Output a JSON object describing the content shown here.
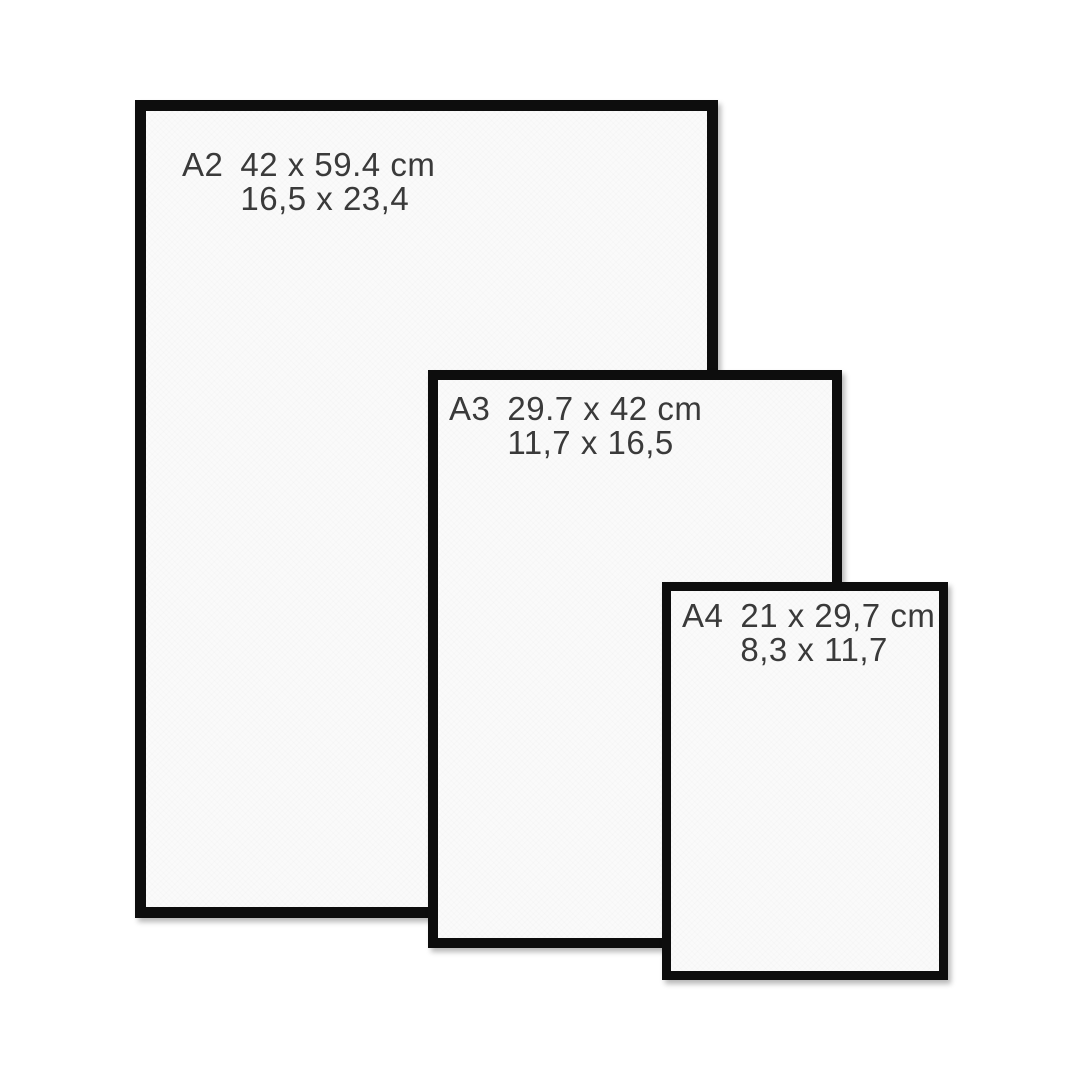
{
  "title": "Frame size comparison A2 A3 A4",
  "colors": {
    "frame": "#0d0d0d",
    "paper": "#fafafa",
    "text": "#3a3a3a",
    "background": "#ffffff"
  },
  "frames": [
    {
      "label": "A2",
      "metric": "42 x 59.4 cm",
      "imperial": "16,5 x 23,4"
    },
    {
      "label": "A3",
      "metric": "29.7 x 42 cm",
      "imperial": "11,7 x 16,5"
    },
    {
      "label": "A4",
      "metric": "21 x 29,7 cm",
      "imperial": "8,3 x 11,7"
    }
  ]
}
